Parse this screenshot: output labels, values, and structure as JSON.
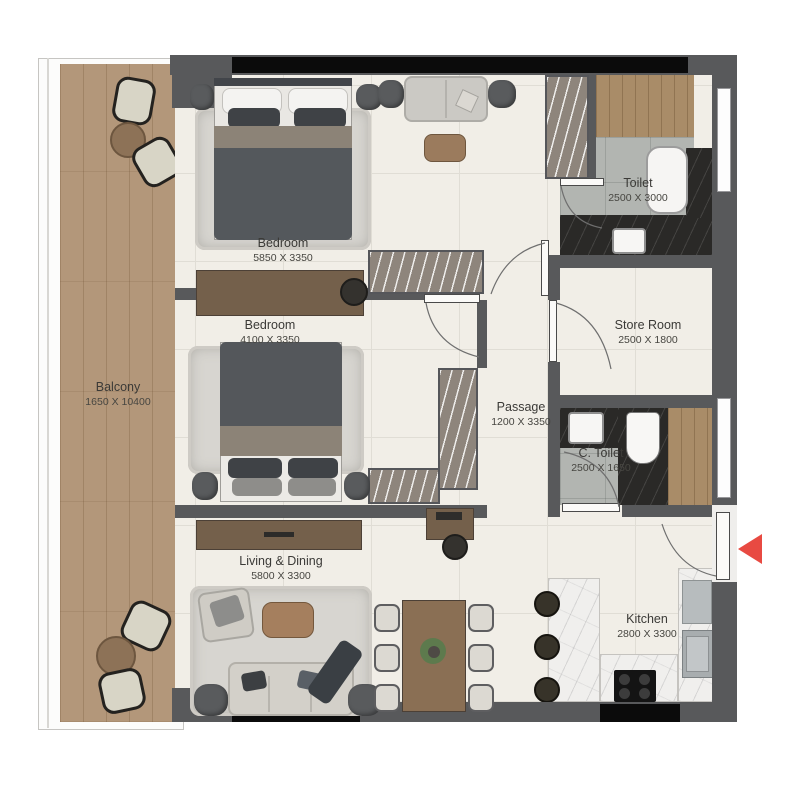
{
  "rooms": [
    {
      "id": "balcony",
      "name": "Balcony",
      "dims": "1650 X 10400"
    },
    {
      "id": "bedroom-1",
      "name": "Bedroom",
      "dims": "5850 X 3350"
    },
    {
      "id": "bedroom-2",
      "name": "Bedroom",
      "dims": "4100 X 3350"
    },
    {
      "id": "toilet",
      "name": "Toilet",
      "dims": "2500 X 3000"
    },
    {
      "id": "store-room",
      "name": "Store Room",
      "dims": "2500 X 1800"
    },
    {
      "id": "passage",
      "name": "Passage",
      "dims": "1200 X 3350"
    },
    {
      "id": "c-toilet",
      "name": "C. Toilet",
      "dims": "2500 X 1650"
    },
    {
      "id": "living-dining",
      "name": "Living & Dining",
      "dims": "5800 X 3300"
    },
    {
      "id": "kitchen",
      "name": "Kitchen",
      "dims": "2800 X 3300"
    }
  ],
  "colors": {
    "wall": "#58595b",
    "window_glass": "#0b0b0b",
    "floor": "#f1eee7",
    "balcony_wood": "#b3977a",
    "tile_gray": "#b2b5b1",
    "dark_marble": "#2a2927",
    "entrance_arrow": "#e84a42"
  }
}
